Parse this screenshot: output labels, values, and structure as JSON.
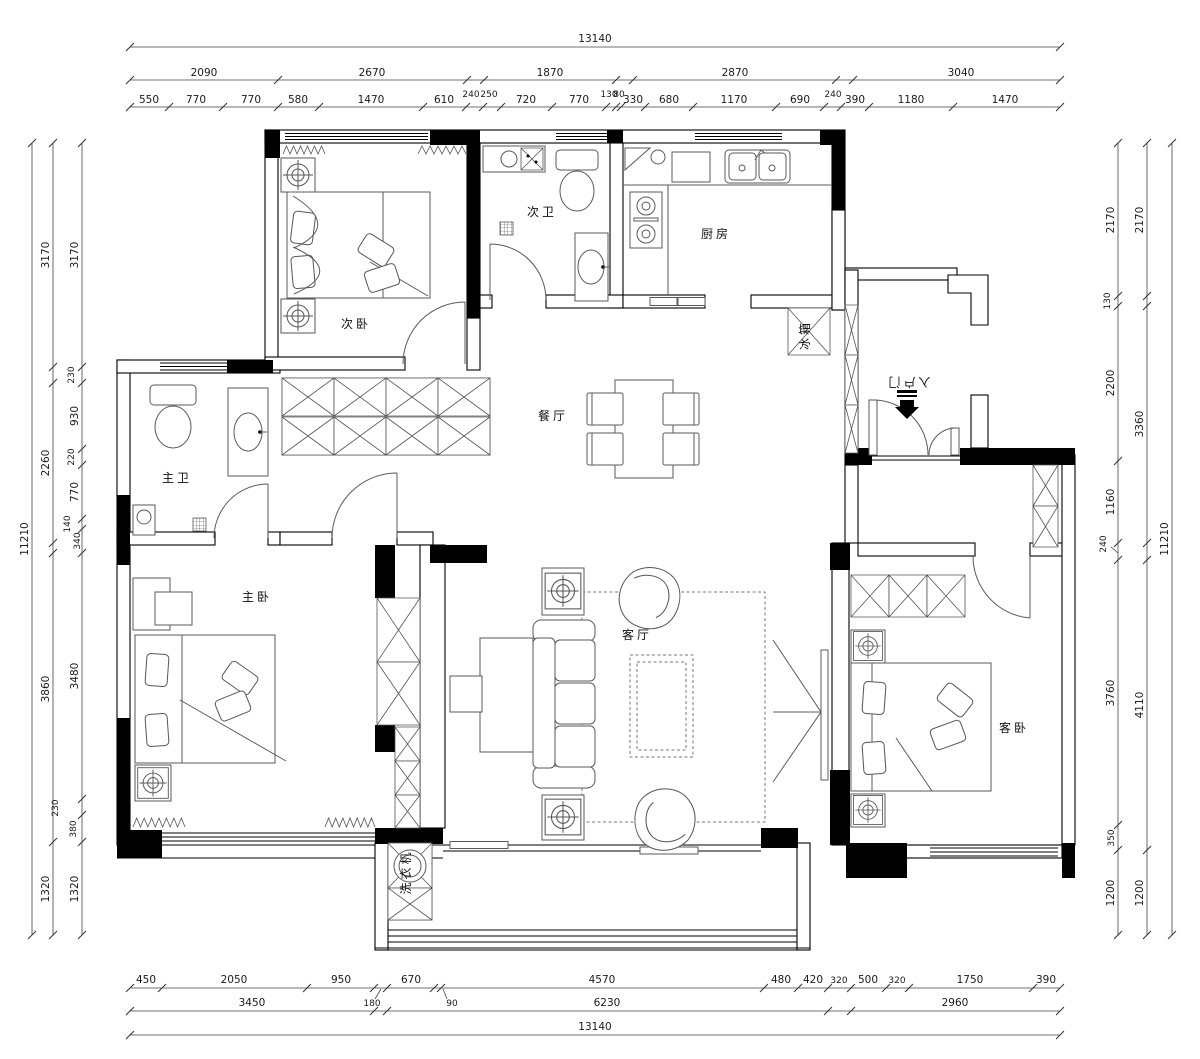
{
  "rooms": {
    "bedroom2": "次卧",
    "bath2": "次卫",
    "kitchen": "厨房",
    "dining": "餐厅",
    "bath1": "主卫",
    "bedroom1": "主卧",
    "living": "客厅",
    "guest": "客卧",
    "entry": "入户门",
    "fridge": "冰箱",
    "washer": "洗衣机"
  },
  "dims": {
    "t1": [
      "13140"
    ],
    "t2": [
      "2090",
      "2670",
      "1870",
      "2870",
      "3040"
    ],
    "t3": [
      "550",
      "770",
      "770",
      "580",
      "1470",
      "610",
      "240",
      "250",
      "720",
      "770",
      "130",
      "80",
      "330",
      "680",
      "1170",
      "690",
      "240",
      "390",
      "1180",
      "1470"
    ],
    "b1": [
      "450",
      "2050",
      "950",
      "180",
      "670",
      "90",
      "4570",
      "480",
      "420",
      "320",
      "500",
      "320",
      "1750",
      "390"
    ],
    "b2": [
      "3450",
      "6230",
      "2960"
    ],
    "b3": [
      "13140"
    ],
    "lo": [
      "11210"
    ],
    "lm": [
      "3170",
      "2260",
      "3860",
      "1320"
    ],
    "li": [
      "3170",
      "230",
      "930",
      "220",
      "770",
      "140",
      "340",
      "3480",
      "230",
      "380",
      "1320"
    ],
    "ri": [
      "2170",
      "130",
      "2200",
      "1160",
      "240",
      "3760",
      "350",
      "1200"
    ],
    "rm": [
      "2170",
      "3360",
      "4110",
      "1200"
    ],
    "ro": [
      "11210"
    ]
  }
}
